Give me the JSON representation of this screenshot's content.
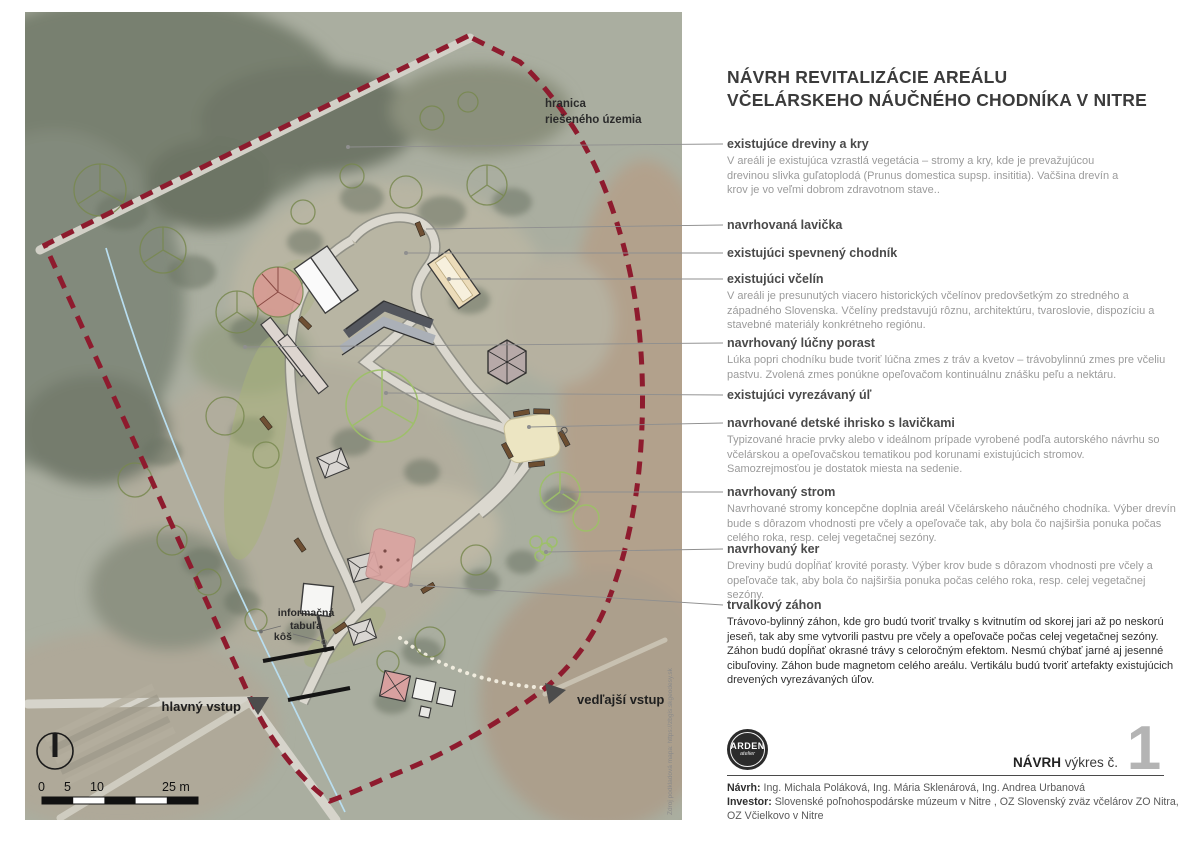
{
  "title": {
    "line1": "NÁVRH REVITALIZÁCIE AREÁLU",
    "line2": "VČELÁRSKEHO NÁUČNÉHO CHODNÍKA V NITRE"
  },
  "annotations": [
    {
      "heading": "existujúce dreviny a kry",
      "body": "V areáli je existujúca vzrastlá vegetácia – stromy a kry, kde je prevažujúcou drevinou  slivka guľatoplodá (Prunus domestica supsp. insititia). Vačšina drevín a krov je vo veľmi dobrom zdravotnom stave.."
    },
    {
      "heading": "navrhovaná lavička",
      "body": ""
    },
    {
      "heading": "existujúci spevnený chodník",
      "body": ""
    },
    {
      "heading": "existujúci včelín",
      "body": "V areáli je presunutých viacero historických včelínov predovšetkým zo stredného a západného Slovenska. Včelíny predstavujú rôznu, architektúru, tvaroslovie, dispozíciu a stavebné materiály konkrétneho regiónu."
    },
    {
      "heading": "navrhovaný lúčny porast",
      "body": "Lúka popri chodníku bude tvoriť lúčna zmes z tráv a kvetov – trávobylinnú zmes pre včeliu pastvu. Zvolená zmes ponúkne opeľovačom kontinuálnu znášku peľu a nektáru."
    },
    {
      "heading": "existujúci vyrezávaný úľ",
      "body": ""
    },
    {
      "heading": "navrhované detské ihrisko s lavičkami",
      "body": "Typizované hracie prvky alebo v ideálnom prípade vyrobené podľa autorského návrhu so včelárskou a opeľovačskou tematikou pod korunami existujúcich stromov. Samozrejmosťou je dostatok miesta na sedenie."
    },
    {
      "heading": "navrhovaný strom",
      "body": "Navrhované stromy koncepčne doplnia areál Včelárskeho náučného chodníka. Výber drevín bude s dôrazom vhodnosti pre včely a opeľovače tak, aby bola čo najširšia ponuka počas celého roka, resp. celej vegetačnej sezóny."
    },
    {
      "heading": "navrhovaný ker",
      "body": "Dreviny budú dopĺňať krovité porasty. Výber krov bude s dôrazom vhodnosti pre včely a opeľovače tak, aby bola čo najširšia ponuka počas celého roka, resp. celej vegetačnej sezóny."
    },
    {
      "heading": "trvalkový záhon",
      "body": "Trávovo-bylinný záhon, kde gro budú tvoriť trvalky s kvitnutím od skorej jari až po neskorú jeseň, tak aby sme vytvorili pastvu pre včely a opeľovače počas celej vegetačnej sezóny. Záhon budú dopĺňať okrasné trávy s celoročným efektom. Nesmú chýbať jarné aj jesenné cibuľoviny. Záhon bude magnetom celého areálu. Vertikálu budú tvoriť artefakty existujúcich drevených vyrezávaných úľov."
    }
  ],
  "map": {
    "boundary_label_line1": "hranica",
    "boundary_label_line2": "riešeného územia",
    "info_board_line1": "informačná",
    "info_board_line2": "tabuľa",
    "bin_label": "kôš",
    "main_entrance": "hlavný vstup",
    "side_entrance": "vedľajší vstup",
    "scale": {
      "ticks": [
        "0",
        "5",
        "10",
        "25 m"
      ]
    },
    "source_note": "Zdroj podkladová mapa: https://zbgis.skgeodesy.sk"
  },
  "footer": {
    "logo_name": "ARDEN",
    "logo_sub": "atelier",
    "stage_label": "NÁVRH",
    "drawing_label": "výkres č.",
    "drawing_number": "1",
    "credit1_label": "Návrh:",
    "credit1_text": " Ing. Michala Poláková, Ing. Mária Sklenárová, Ing. Andrea Urbanová",
    "credit2_label": "Investor:",
    "credit2_text": " Slovenské poľnohospodárske múzeum v Nitre , OZ Slovenský zväz včelárov ZO Nitra, OZ Včielkovo v Nitre"
  },
  "colors": {
    "boundary_red": "#8e1b2e",
    "leader_gray": "#8f8f8f",
    "heading_gray": "#4a4a4a",
    "body_gray": "#9b9b9b",
    "meadow_green": "#a7b27a",
    "stream_blue": "#b9def0",
    "perennial_pink": "#dba4a1",
    "playground_cream": "#ece5c2",
    "drawing_number_gray": "#b4b4b4"
  }
}
